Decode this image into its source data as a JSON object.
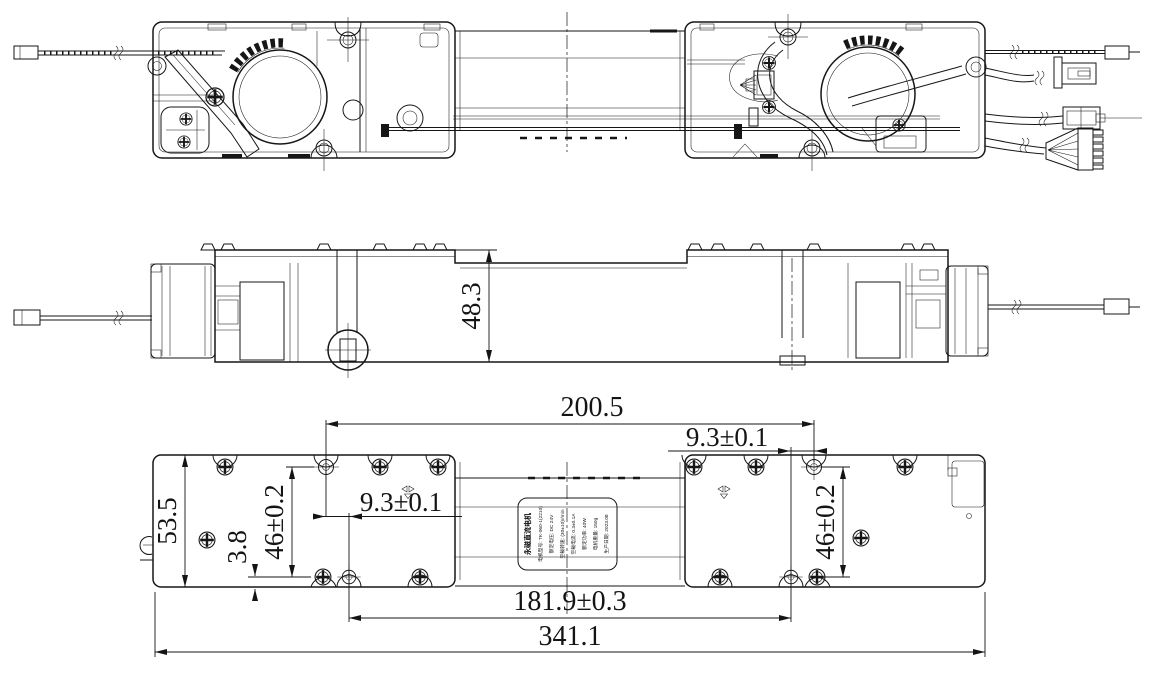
{
  "drawing": {
    "type": "engineering-three-view",
    "views": {
      "top": "top assembly view",
      "side": "side elevation view",
      "bottom": "bottom mounting view"
    }
  },
  "dimensions": {
    "side_height": "48.3",
    "mount_hole_span": "200.5",
    "hole_offset_right": "9.3±0.1",
    "hole_offset_left": "9.3±0.1",
    "body_height": "53.5",
    "hole_pitch_left": "46±0.2",
    "hole_pitch_right": "46±0.2",
    "bottom_edge_gap": "3.8",
    "mount_pitch": "181.9±0.3",
    "overall_length": "341.1"
  },
  "nameplate": {
    "title": "永磁直流电机",
    "lines": [
      "电机型号: TK-060-1(2210)",
      "额定电压: DC 24V",
      "空载转速: (30±10)r/min",
      "空载电流: 0.3±0.1A",
      "额定功率: 40W",
      "电机重量: 150g",
      "生产日期: 2023.08"
    ]
  },
  "colors": {
    "line": "#161616",
    "background": "#ffffff"
  }
}
